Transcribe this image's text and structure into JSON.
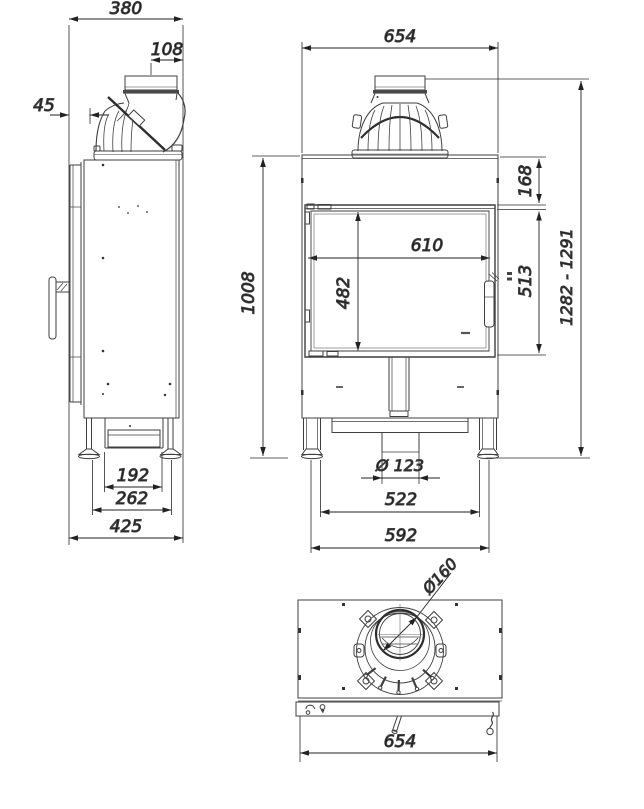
{
  "drawing": {
    "kind": "technical dimensional drawing",
    "subject": "fireplace insert with flue elbow, three orthographic views",
    "colors": {
      "line": "#3f3f3f",
      "dim_line": "#222222",
      "text": "#141414",
      "background": "#ffffff"
    }
  },
  "dims": {
    "side": {
      "depth_total": "380",
      "flue_offset": "108",
      "front_offset": "45",
      "base_inner": "192",
      "base_mid": "262",
      "base_depth": "425"
    },
    "front": {
      "width_total": "654",
      "body_height": "1008",
      "top_to_door": "168",
      "glass_width": "610",
      "firebox_height": "482",
      "door_height": "513",
      "height_range": "1282 - 1291",
      "air_inlet_dia": "Ø 123",
      "feet_span_inner": "522",
      "feet_span_outer": "592"
    },
    "top": {
      "flue_dia": "Ø160",
      "width_total": "654"
    }
  }
}
